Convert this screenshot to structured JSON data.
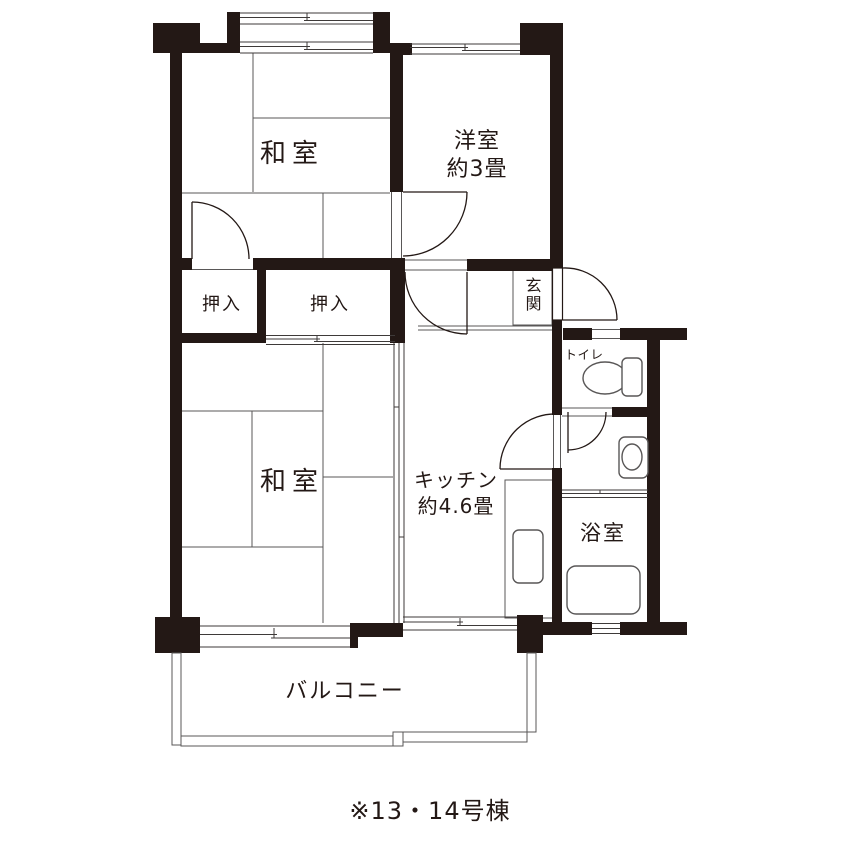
{
  "floorplan": {
    "caption": "※13・14号棟",
    "colors": {
      "wall": "#231815",
      "line": "#595757",
      "bg": "#ffffff"
    },
    "rooms": {
      "washitsu_upper": {
        "label": "和室"
      },
      "washitsu_lower": {
        "label": "和室"
      },
      "yoshitsu": {
        "label": "洋室",
        "size": "約3畳"
      },
      "kitchen": {
        "label": "キッチン",
        "size": "約4.6畳"
      },
      "oshiire_left": {
        "label": "押入"
      },
      "oshiire_right": {
        "label": "押入"
      },
      "genkan": {
        "label": "玄関"
      },
      "toilet": {
        "label": "トイレ"
      },
      "bath": {
        "label": "浴室"
      },
      "balcony": {
        "label": "バルコニー"
      }
    },
    "fixtures": {
      "toilet": "toilet-bowl-with-tank",
      "basin": "washbasin",
      "bathtub": "bathtub",
      "kitchen_sink": "kitchen-counter-sink"
    }
  }
}
